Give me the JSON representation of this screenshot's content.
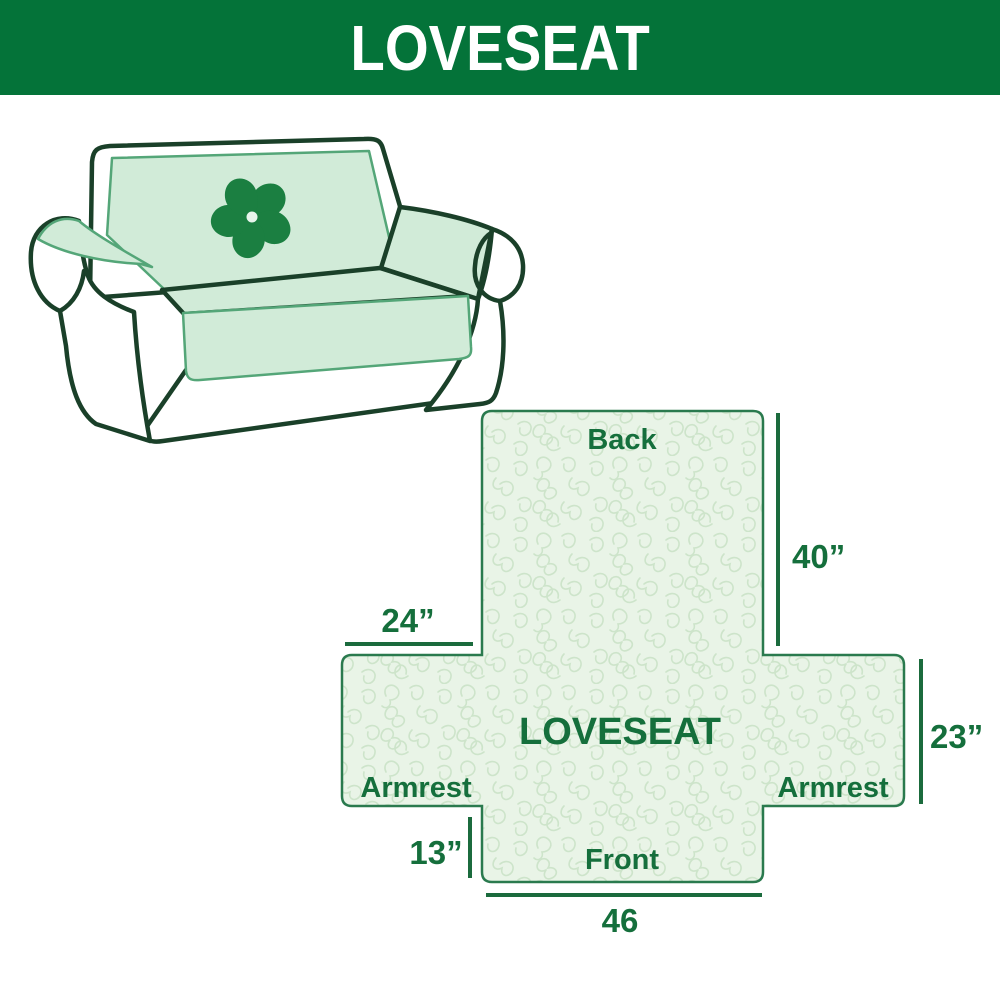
{
  "banner": {
    "title": "LOVESEAT"
  },
  "sofa": {
    "description": "loveseat sofa line illustration with light green protective cover",
    "logo": "pinwheel-fan-logo"
  },
  "diagram": {
    "center_label": "LOVESEAT",
    "back_label": "Back",
    "front_label": "Front",
    "armrest_left_label": "Armrest",
    "armrest_right_label": "Armrest",
    "dim_back_length": "40”",
    "dim_armrest_width": "24”",
    "dim_armrest_height": "23”",
    "dim_front_drop": "13”",
    "dim_front_width": "46"
  },
  "colors": {
    "banner_green": "#047339",
    "banner_text": "#ffffff",
    "label_green": "#156f3c",
    "dimension_line_green": "#1b6b3d",
    "diagram_fill": "#e9f4e7",
    "diagram_pattern": "#cde4ca",
    "diagram_border": "#2a7a4e",
    "sofa_outline": "#1a4029",
    "cover_green": "#d1ebd8",
    "logo_green": "#1b7f41"
  }
}
